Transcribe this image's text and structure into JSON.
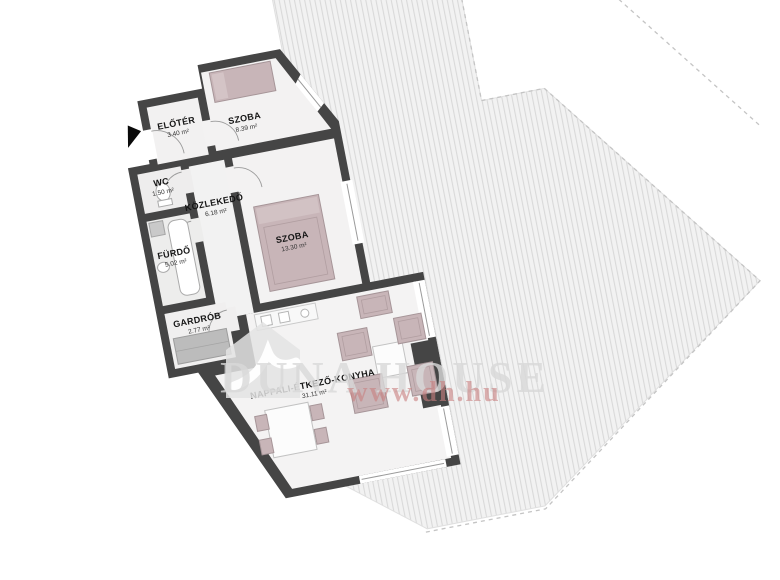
{
  "rooms": [
    {
      "name": "ELŐTÉR",
      "area": "3.40 m²"
    },
    {
      "name": "SZOBA",
      "area": "8.39 m²"
    },
    {
      "name": "WC",
      "area": "1.50 m²"
    },
    {
      "name": "KÖZLEKEDŐ",
      "area": "6.18 m²"
    },
    {
      "name": "SZOBA",
      "area": "13.30 m²"
    },
    {
      "name": "FÜRDŐ",
      "area": "5.02 m²"
    },
    {
      "name": "GARDRÓB",
      "area": "2.77 m²"
    },
    {
      "name": "NAPPALI-ÉTKEZŐ-KONYHA",
      "area": "31.11 m²"
    }
  ],
  "watermark": {
    "brand": "DUNA HOUSE",
    "url": "www.dh.hu"
  },
  "icons": {
    "entrance_arrow": "triangle-pointer",
    "logo": "duna-house-bird-in-house"
  },
  "colors": {
    "wall": "#454545",
    "room_floor": "#f2f1f1",
    "furniture_mauve": "#c8b5b8",
    "hatch_bg": "#f2f2f2",
    "hatch_line": "#d9d9d9",
    "dashed_boundary": "#c4c4c4",
    "watermark_gray": "#d9d9d9",
    "watermark_red": "#c98080",
    "arrow_black": "#0a0a0a"
  }
}
